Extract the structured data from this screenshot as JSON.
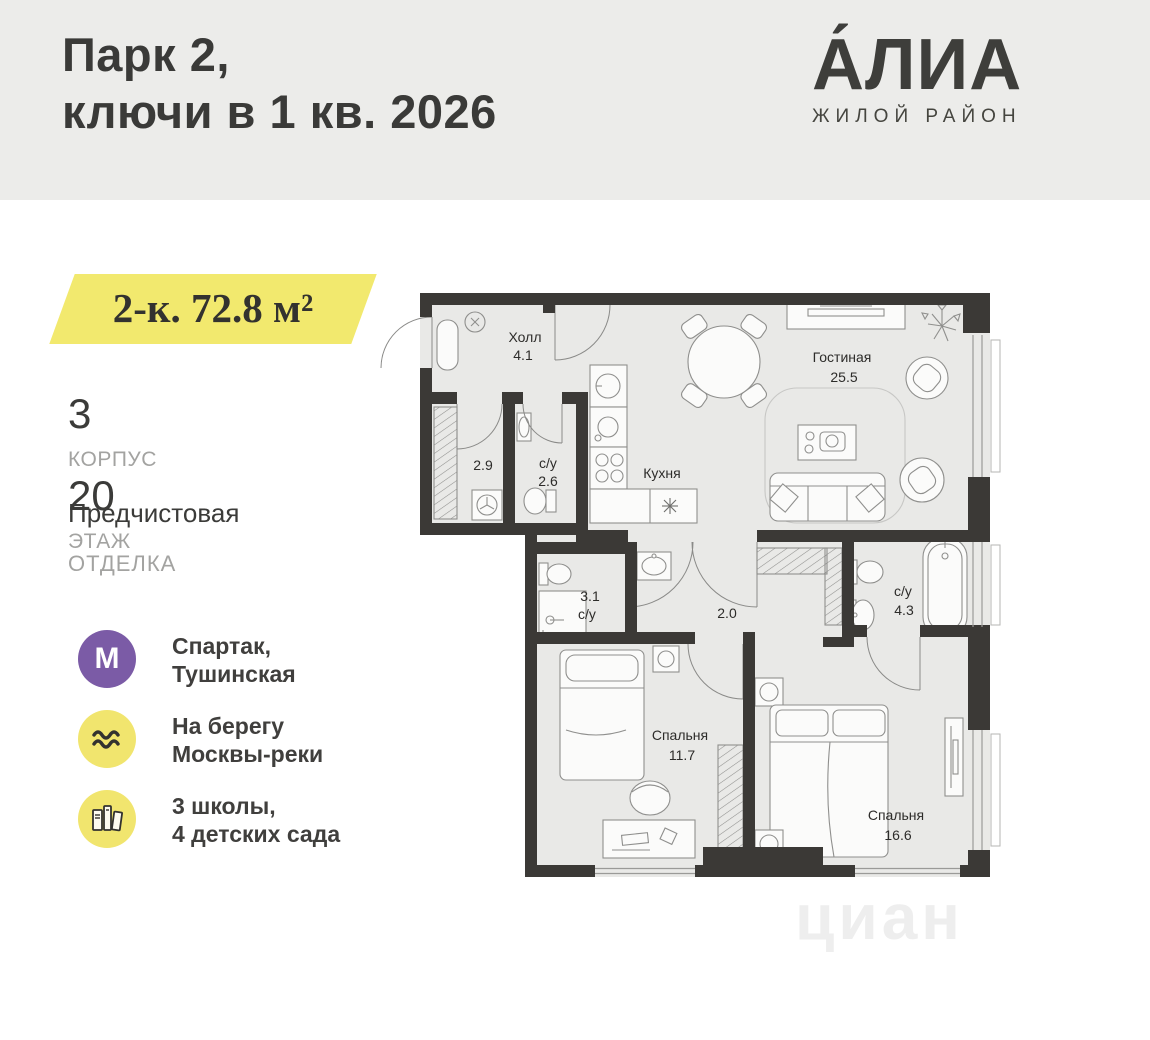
{
  "header": {
    "title_line1": "Парк 2,",
    "title_line2": "ключи в 1 кв. 2026",
    "logo_name": "А́ЛИА",
    "logo_subtitle": "ЖИЛОЙ РАЙОН"
  },
  "listing": {
    "area_badge": "2-к. 72.8 м²",
    "building_value": "3",
    "building_label": "КОРПУС",
    "floor_value": "20",
    "floor_label": "ЭТАЖ",
    "finish_value": "Предчистовая",
    "finish_label": "ОТДЕЛКА"
  },
  "features": [
    {
      "icon": "metro-icon",
      "line1": "Спартак,",
      "line2": "Тушинская"
    },
    {
      "icon": "river-icon",
      "line1": "На берегу",
      "line2": "Москвы-реки"
    },
    {
      "icon": "schools-icon",
      "line1": "3 школы,",
      "line2": "4 детских сада"
    }
  ],
  "floor_plan": {
    "rooms": {
      "hall": {
        "name": "Холл",
        "area": "4.1"
      },
      "wardrobe": {
        "name": "",
        "area": "2.9"
      },
      "bath1": {
        "name": "с/у",
        "area": "2.6"
      },
      "kitchen": {
        "name": "Кухня",
        "area": ""
      },
      "living": {
        "name": "Гостиная",
        "area": "25.5"
      },
      "bath2": {
        "name": "с/у",
        "area": "3.1"
      },
      "corridor": {
        "name": "",
        "area": "2.0"
      },
      "bath3": {
        "name": "с/у",
        "area": "4.3"
      },
      "bedroom1": {
        "name": "Спальня",
        "area": "11.7"
      },
      "bedroom2": {
        "name": "Спальня",
        "area": "16.6"
      }
    }
  },
  "watermark": "циан",
  "colors": {
    "header_bg": "#ECECEA",
    "accent_yellow": "#F2E96E",
    "metro_purple": "#7B5BA6",
    "wall_dark": "#3B3936",
    "floor_fill": "#E9E9E7"
  }
}
